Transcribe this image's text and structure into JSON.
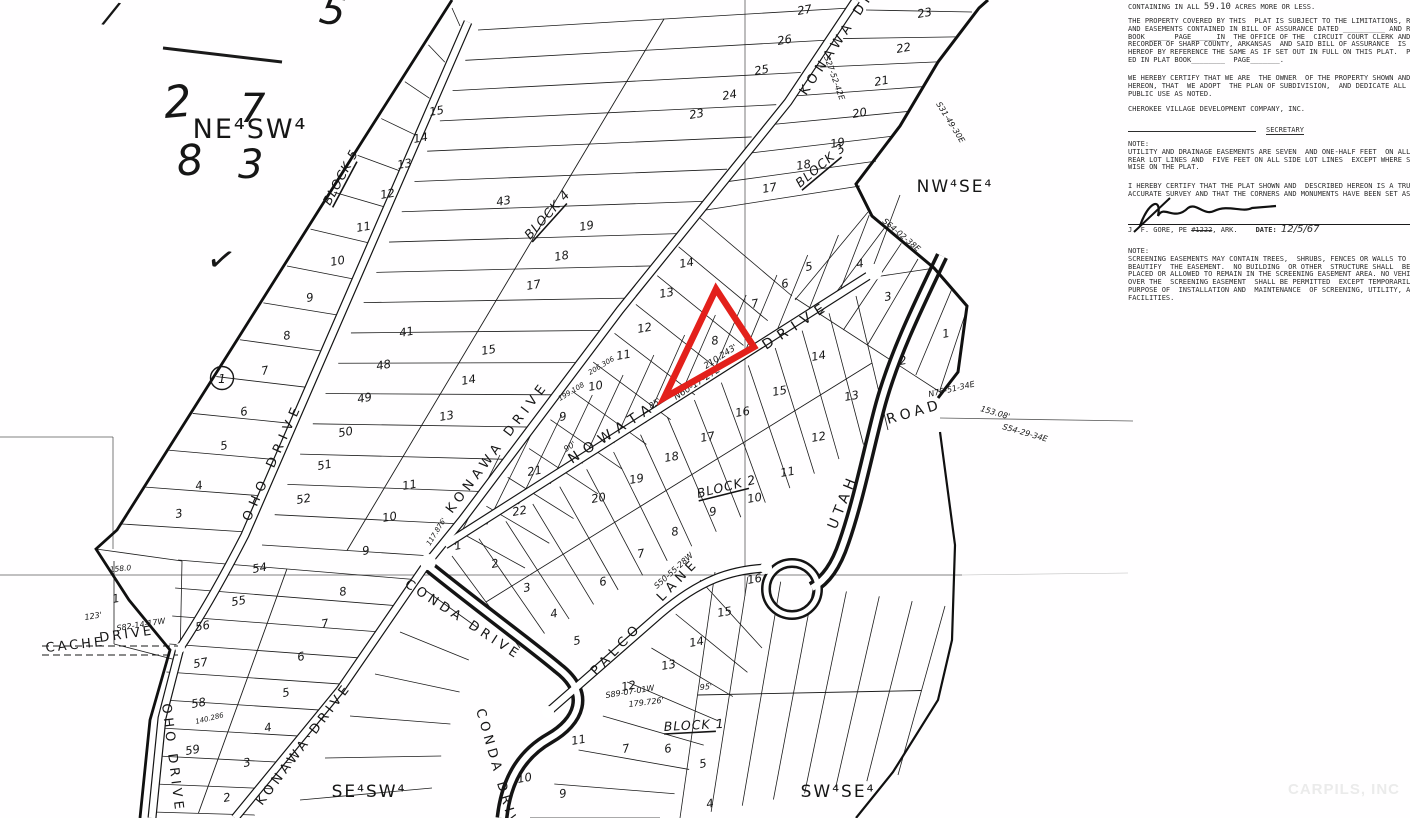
{
  "page": {
    "watermark": "CARPILS, INC"
  },
  "notes_panel": {
    "containing": {
      "pre": "CONTAINING IN ALL ",
      "acreage": "59.10",
      "post": " ACRES MORE OR LESS."
    },
    "para_property": [
      "THE PROPERTY COVERED BY THIS  PLAT IS SUBJECT TO THE LIMITATIONS, RE",
      "AND EASEMENTS CONTAINED IN BILL OF ASSURANCE DATED __________ AND R",
      "BOOK _____ PAGE______IN  THE OFFICE OF THE  CIRCUIT COURT CLERK AND R",
      "RECORDER OF SHARP COUNTY, ARKANSAS  AND SAID BILL OF ASSURANCE  IS M",
      "HEREOF BY REFERENCE THE SAME AS IF SET OUT IN FULL ON THIS PLAT.  PL",
      "ED IN PLAT BOOK________  PAGE_______."
    ],
    "para_owner": [
      "WE HEREBY CERTIFY THAT WE ARE  THE OWNER  OF THE PROPERTY SHOWN AND",
      "HEREON, THAT  WE ADOPT  THE PLAN OF SUBDIVISION,  AND DEDICATE ALL",
      "PUBLIC USE AS NOTED."
    ],
    "company": "CHEROKEE VILLAGE DEVELOPMENT COMPANY, INC.",
    "secretary_label": "SECRETARY",
    "note1": [
      "NOTE:",
      "UTILITY AND DRAINAGE EASEMENTS ARE SEVEN  AND ONE-HALF FEET  ON ALL",
      "REAR LOT LINES AND  FIVE FEET ON ALL SIDE LOT LINES  EXCEPT WHERE SH",
      "WISE ON THE PLAT."
    ],
    "para_survey": [
      "I HEREBY CERTIFY THAT THE PLAT SHOWN AND  DESCRIBED HEREON IS A TRUE",
      "ACCURATE SURVEY AND THAT THE CORNERS AND MONUMENTS HAVE BEEN SET AS"
    ],
    "surveyor": {
      "name": "J. F. GORE, PE ",
      "number": "#1222",
      "suffix": ", ARK.",
      "date_label": "DATE:",
      "date_value": "12/5/67"
    },
    "note2": [
      "NOTE:",
      "SCREENING EASEMENTS MAY CONTAIN TREES,  SHRUBS, FENCES OR WALLS TO PRO",
      "BEAUTIFY  THE EASEMENT.  NO BUILDING  OR OTHER  STRUCTURE SHALL  BE ER",
      "PLACED OR ALLOWED TO REMAIN IN THE SCREENING EASEMENT AREA. NO VEHICUL",
      "OVER THE  SCREENING EASEMENT  SHALL BE PERMITTED  EXCEPT TEMPORARILY",
      "PURPOSE OF  INSTALLATION AND  MAINTENANCE  OF SCREENING, UTILITY, AND",
      "FACILITIES."
    ]
  },
  "map": {
    "quadrant_labels": [
      {
        "text": "NE⁴SW⁴",
        "x": 250,
        "y": 138,
        "size": 27
      },
      {
        "text": "NW⁴SE⁴",
        "x": 955,
        "y": 192,
        "size": 17
      },
      {
        "text": "SE⁴SW⁴",
        "x": 369,
        "y": 797,
        "size": 17
      },
      {
        "text": "SW⁴SE⁴",
        "x": 838,
        "y": 797,
        "size": 17
      }
    ],
    "street_labels": [
      {
        "text": "KONAWA DRIVE",
        "x": 806,
        "y": 96,
        "rot": -56,
        "size": 13,
        "ls": 5
      },
      {
        "text": "KONAWA DRIVE",
        "x": 452,
        "y": 514,
        "rot": -53,
        "size": 13,
        "ls": 5
      },
      {
        "text": "KONAWA DRIVE",
        "x": 262,
        "y": 806,
        "rot": -53,
        "size": 13,
        "ls": 4
      },
      {
        "text": "OHO DRIVE",
        "x": 250,
        "y": 522,
        "rot": -66,
        "size": 13,
        "ls": 6
      },
      {
        "text": "OHO DRIVE",
        "x": 162,
        "y": 704,
        "rot": 83,
        "size": 13,
        "ls": 4
      },
      {
        "text": "NOWATA",
        "x": 572,
        "y": 464,
        "rot": -33,
        "size": 14,
        "ls": 7
      },
      {
        "text": "DRIVE",
        "x": 766,
        "y": 350,
        "rot": -33,
        "size": 14,
        "ls": 7
      },
      {
        "text": "UTAH",
        "x": 836,
        "y": 530,
        "rot": -68,
        "size": 14,
        "ls": 5
      },
      {
        "text": "ROAD",
        "x": 888,
        "y": 424,
        "rot": -16,
        "size": 14,
        "ls": 4
      },
      {
        "text": "CONDA DRIVE",
        "x": 404,
        "y": 586,
        "rot": 33,
        "size": 13,
        "ls": 4
      },
      {
        "text": "CONDA DRIVE",
        "x": 476,
        "y": 710,
        "rot": 74,
        "size": 13,
        "ls": 4
      },
      {
        "text": "PALCO",
        "x": 596,
        "y": 676,
        "rot": -46,
        "size": 13,
        "ls": 5
      },
      {
        "text": "LANE",
        "x": 662,
        "y": 602,
        "rot": -46,
        "size": 13,
        "ls": 5
      },
      {
        "text": "CACHE",
        "x": 46,
        "y": 652,
        "rot": -6,
        "size": 13,
        "ls": 3
      },
      {
        "text": "DRIVE",
        "x": 100,
        "y": 642,
        "rot": -8,
        "size": 13,
        "ls": 3
      }
    ],
    "block_labels": [
      {
        "text": "BLOCK 5",
        "x": 330,
        "y": 206,
        "rot": -62
      },
      {
        "text": "BLOCK 4",
        "x": 530,
        "y": 240,
        "rot": -48
      },
      {
        "text": "BLOCK 3",
        "x": 800,
        "y": 188,
        "rot": -40
      },
      {
        "text": "BLOCK 2",
        "x": 698,
        "y": 498,
        "rot": -14
      },
      {
        "text": "BLOCK 1",
        "x": 664,
        "y": 731,
        "rot": -3
      }
    ],
    "lot_numbers": [
      [
        "15",
        430,
        116
      ],
      [
        "14",
        414,
        143
      ],
      [
        "13",
        398,
        169
      ],
      [
        "12",
        381,
        199
      ],
      [
        "11",
        357,
        232
      ],
      [
        "10",
        331,
        266
      ],
      [
        "9",
        307,
        302
      ],
      [
        "8",
        284,
        340
      ],
      [
        "7",
        262,
        375
      ],
      [
        "6",
        241,
        416
      ],
      [
        "5",
        221,
        450
      ],
      [
        "4",
        196,
        490
      ],
      [
        "3",
        176,
        518
      ],
      [
        "41",
        400,
        337
      ],
      [
        "48",
        377,
        370
      ],
      [
        "49",
        358,
        403
      ],
      [
        "50",
        339,
        437
      ],
      [
        "51",
        318,
        470
      ],
      [
        "52",
        297,
        504
      ],
      [
        "43",
        497,
        206
      ],
      [
        "19",
        580,
        231
      ],
      [
        "18",
        555,
        261
      ],
      [
        "17",
        527,
        290
      ],
      [
        "27",
        798,
        15
      ],
      [
        "26",
        778,
        45
      ],
      [
        "25",
        755,
        75
      ],
      [
        "24",
        723,
        100
      ],
      [
        "23",
        690,
        119
      ],
      [
        "23",
        918,
        18
      ],
      [
        "22",
        897,
        53
      ],
      [
        "21",
        875,
        86
      ],
      [
        "20",
        853,
        118
      ],
      [
        "19",
        831,
        148
      ],
      [
        "18",
        797,
        170
      ],
      [
        "17",
        763,
        193
      ],
      [
        "14",
        680,
        268
      ],
      [
        "13",
        660,
        298
      ],
      [
        "12",
        638,
        333
      ],
      [
        "11",
        617,
        360
      ],
      [
        "10",
        589,
        391
      ],
      [
        "9",
        560,
        421
      ],
      [
        "15",
        482,
        355
      ],
      [
        "14",
        462,
        385
      ],
      [
        "13",
        440,
        421
      ],
      [
        "8",
        712,
        345
      ],
      [
        "7",
        752,
        308
      ],
      [
        "6",
        782,
        288
      ],
      [
        "5",
        806,
        271
      ],
      [
        "4",
        857,
        268
      ],
      [
        "3",
        885,
        301
      ],
      [
        "2",
        900,
        365
      ],
      [
        "1",
        943,
        338
      ],
      [
        "16",
        736,
        417
      ],
      [
        "15",
        773,
        396
      ],
      [
        "14",
        812,
        361
      ],
      [
        "13",
        845,
        401
      ],
      [
        "12",
        812,
        442
      ],
      [
        "17",
        701,
        442
      ],
      [
        "18",
        665,
        462
      ],
      [
        "19",
        630,
        484
      ],
      [
        "20",
        592,
        503
      ],
      [
        "21",
        528,
        476
      ],
      [
        "9",
        710,
        516
      ],
      [
        "8",
        672,
        536
      ],
      [
        "7",
        638,
        558
      ],
      [
        "6",
        600,
        586
      ],
      [
        "10",
        748,
        503
      ],
      [
        "11",
        781,
        477
      ],
      [
        "16",
        748,
        584
      ],
      [
        "22",
        513,
        516
      ],
      [
        "1",
        455,
        550
      ],
      [
        "2",
        492,
        568
      ],
      [
        "3",
        524,
        592
      ],
      [
        "4",
        551,
        618
      ],
      [
        "5",
        574,
        645
      ],
      [
        "11",
        403,
        490
      ],
      [
        "10",
        383,
        522
      ],
      [
        "9",
        363,
        555
      ],
      [
        "54",
        253,
        573
      ],
      [
        "55",
        232,
        606
      ],
      [
        "56",
        196,
        631
      ],
      [
        "57",
        194,
        668
      ],
      [
        "58",
        192,
        708
      ],
      [
        "59",
        186,
        755
      ],
      [
        "8",
        340,
        596
      ],
      [
        "7",
        322,
        628
      ],
      [
        "6",
        298,
        661
      ],
      [
        "5",
        283,
        697
      ],
      [
        "4",
        265,
        732
      ],
      [
        "3",
        244,
        767
      ],
      [
        "2",
        224,
        802
      ],
      [
        "1",
        113,
        603
      ],
      [
        "15",
        718,
        617
      ],
      [
        "14",
        690,
        647
      ],
      [
        "13",
        662,
        670
      ],
      [
        "12",
        622,
        691
      ],
      [
        "11",
        572,
        745
      ],
      [
        "10",
        518,
        783
      ],
      [
        "9",
        560,
        798
      ],
      [
        "7",
        623,
        753
      ],
      [
        "6",
        665,
        753
      ],
      [
        "5",
        700,
        768
      ],
      [
        "4",
        707,
        808
      ]
    ],
    "annotations": [
      [
        "N60-17-27E",
        676,
        400,
        -33,
        9
      ],
      [
        "210.243'",
        706,
        369,
        -33,
        8.5
      ],
      [
        "S64-02-38E",
        882,
        222,
        40,
        8
      ],
      [
        "N76-51-34E",
        929,
        397,
        -13,
        8
      ],
      [
        "153.08'",
        980,
        411,
        16,
        8
      ],
      [
        "S54-29-34E",
        1002,
        429,
        16,
        8
      ],
      [
        "S27-52-42E",
        824,
        57,
        70,
        8
      ],
      [
        "S31-49-30E",
        936,
        104,
        58,
        8
      ],
      [
        "S82-14-17W",
        117,
        631,
        -9,
        8
      ],
      [
        "123'",
        85,
        620,
        -9,
        8
      ],
      [
        "S89-07-01W",
        606,
        698,
        -9,
        8
      ],
      [
        "179.726'",
        629,
        707,
        -7,
        8
      ],
      [
        "S50-55-28W",
        657,
        589,
        -42,
        8
      ],
      [
        "158.0",
        110,
        572,
        -5,
        7.5
      ],
      [
        "199.108",
        560,
        401,
        -31,
        7
      ],
      [
        "206.306",
        590,
        375,
        -31,
        7
      ],
      [
        "117.876'",
        430,
        546,
        -58,
        7
      ],
      [
        "140.286",
        196,
        724,
        -14,
        7
      ],
      [
        "85'",
        651,
        409,
        -33,
        8
      ],
      [
        "90'",
        566,
        452,
        -33,
        8
      ],
      [
        "95'",
        700,
        690,
        -5,
        8
      ]
    ],
    "monument": {
      "text": "1",
      "x": 222,
      "y": 382
    },
    "highlight": {
      "lot": "8",
      "color": "#e3201b",
      "points": "716,289 754,347 664,398"
    },
    "handwriting": [
      {
        "text": "2",
        "x": 165,
        "y": 118,
        "size": 44,
        "rot": -5
      },
      {
        "text": "7",
        "x": 240,
        "y": 122,
        "size": 40,
        "rot": 0
      },
      {
        "text": "8",
        "x": 178,
        "y": 176,
        "size": 42,
        "rot": -6
      },
      {
        "text": "3",
        "x": 238,
        "y": 178,
        "size": 40,
        "rot": 0
      },
      {
        "text": "✓",
        "x": 205,
        "y": 268,
        "size": 34,
        "rot": 12
      },
      {
        "text": "5",
        "x": 318,
        "y": 22,
        "size": 40,
        "rot": 10
      },
      {
        "text": "/",
        "x": 104,
        "y": 22,
        "size": 30,
        "rot": 12
      }
    ]
  }
}
